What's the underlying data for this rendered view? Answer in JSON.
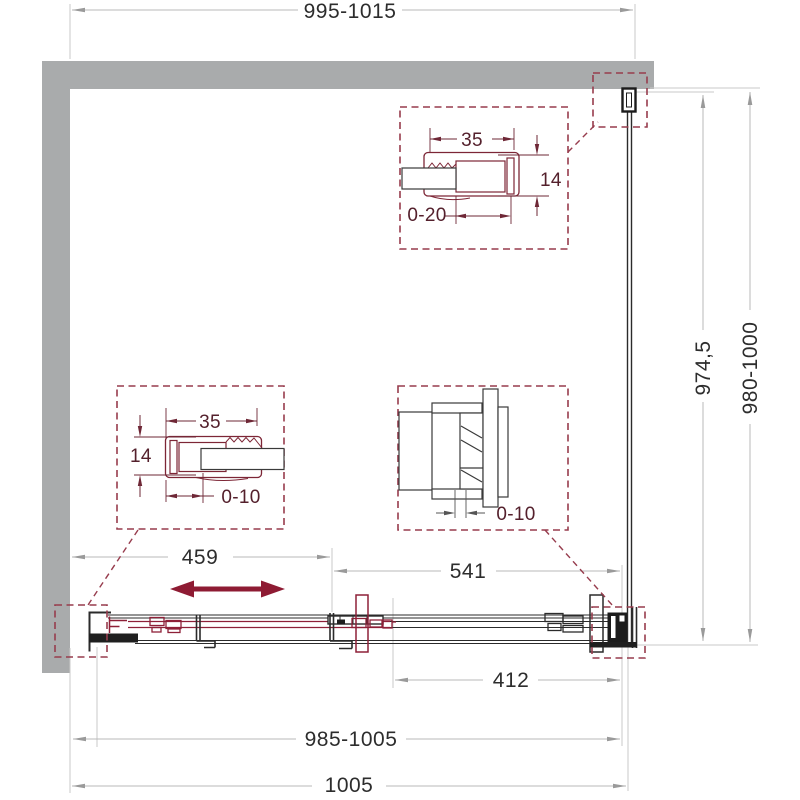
{
  "drawing": {
    "type": "shower-enclosure-sliding-door-technical-drawing",
    "colors": {
      "wall": "#a9abac",
      "accent": "#8e1b33",
      "detail_dashed": "#973c4d",
      "dim_lines": "#b9b9b9",
      "text": "#2d2d2d"
    },
    "dims": {
      "top_width": "995-1015",
      "glass_height": "974,5",
      "total_height": "980-1000",
      "left_section": "459",
      "right_section": "541",
      "lower_right": "412",
      "bottom_width": "985-1005",
      "overall_width": "1005"
    },
    "detail_top": {
      "width": "35",
      "height": "14",
      "adjust": "0-20"
    },
    "detail_left": {
      "width": "35",
      "height": "14",
      "adjust": "0-10"
    },
    "detail_right": {
      "adjust": "0-10"
    }
  }
}
